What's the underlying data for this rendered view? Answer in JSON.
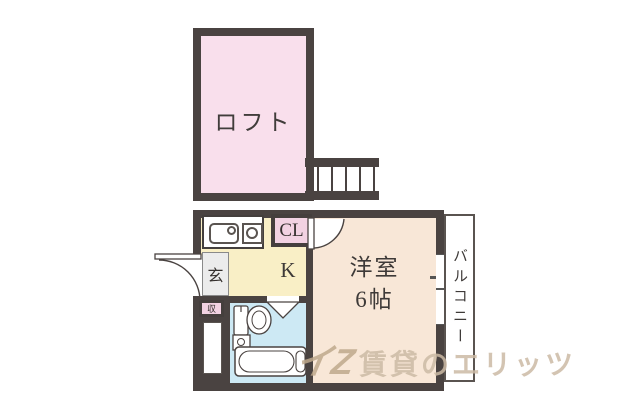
{
  "plan": {
    "loft": {
      "label": "ロフト"
    },
    "lower": {
      "closet_label": "CL",
      "entrance_label": "玄",
      "kitchen_label": "K",
      "storage_label": "収",
      "room_label": "洋室",
      "room_size": "6帖",
      "balcony_label": "バルコニー"
    },
    "colors": {
      "wall": "#4a4341",
      "loft_pink": "#f9dfec",
      "closet_pink": "#f2d2e2",
      "kitchen_yellow": "#f9efc6",
      "room_peach": "#f8e7d7",
      "bath_blue": "#cde9f4",
      "entrance_gray": "#ececec",
      "label_text": "#3e3a38",
      "watermark": "#cbbaa4"
    }
  },
  "watermark": {
    "logo_glyph": "イZ",
    "brand_text": "賃貸のエリッツ"
  }
}
